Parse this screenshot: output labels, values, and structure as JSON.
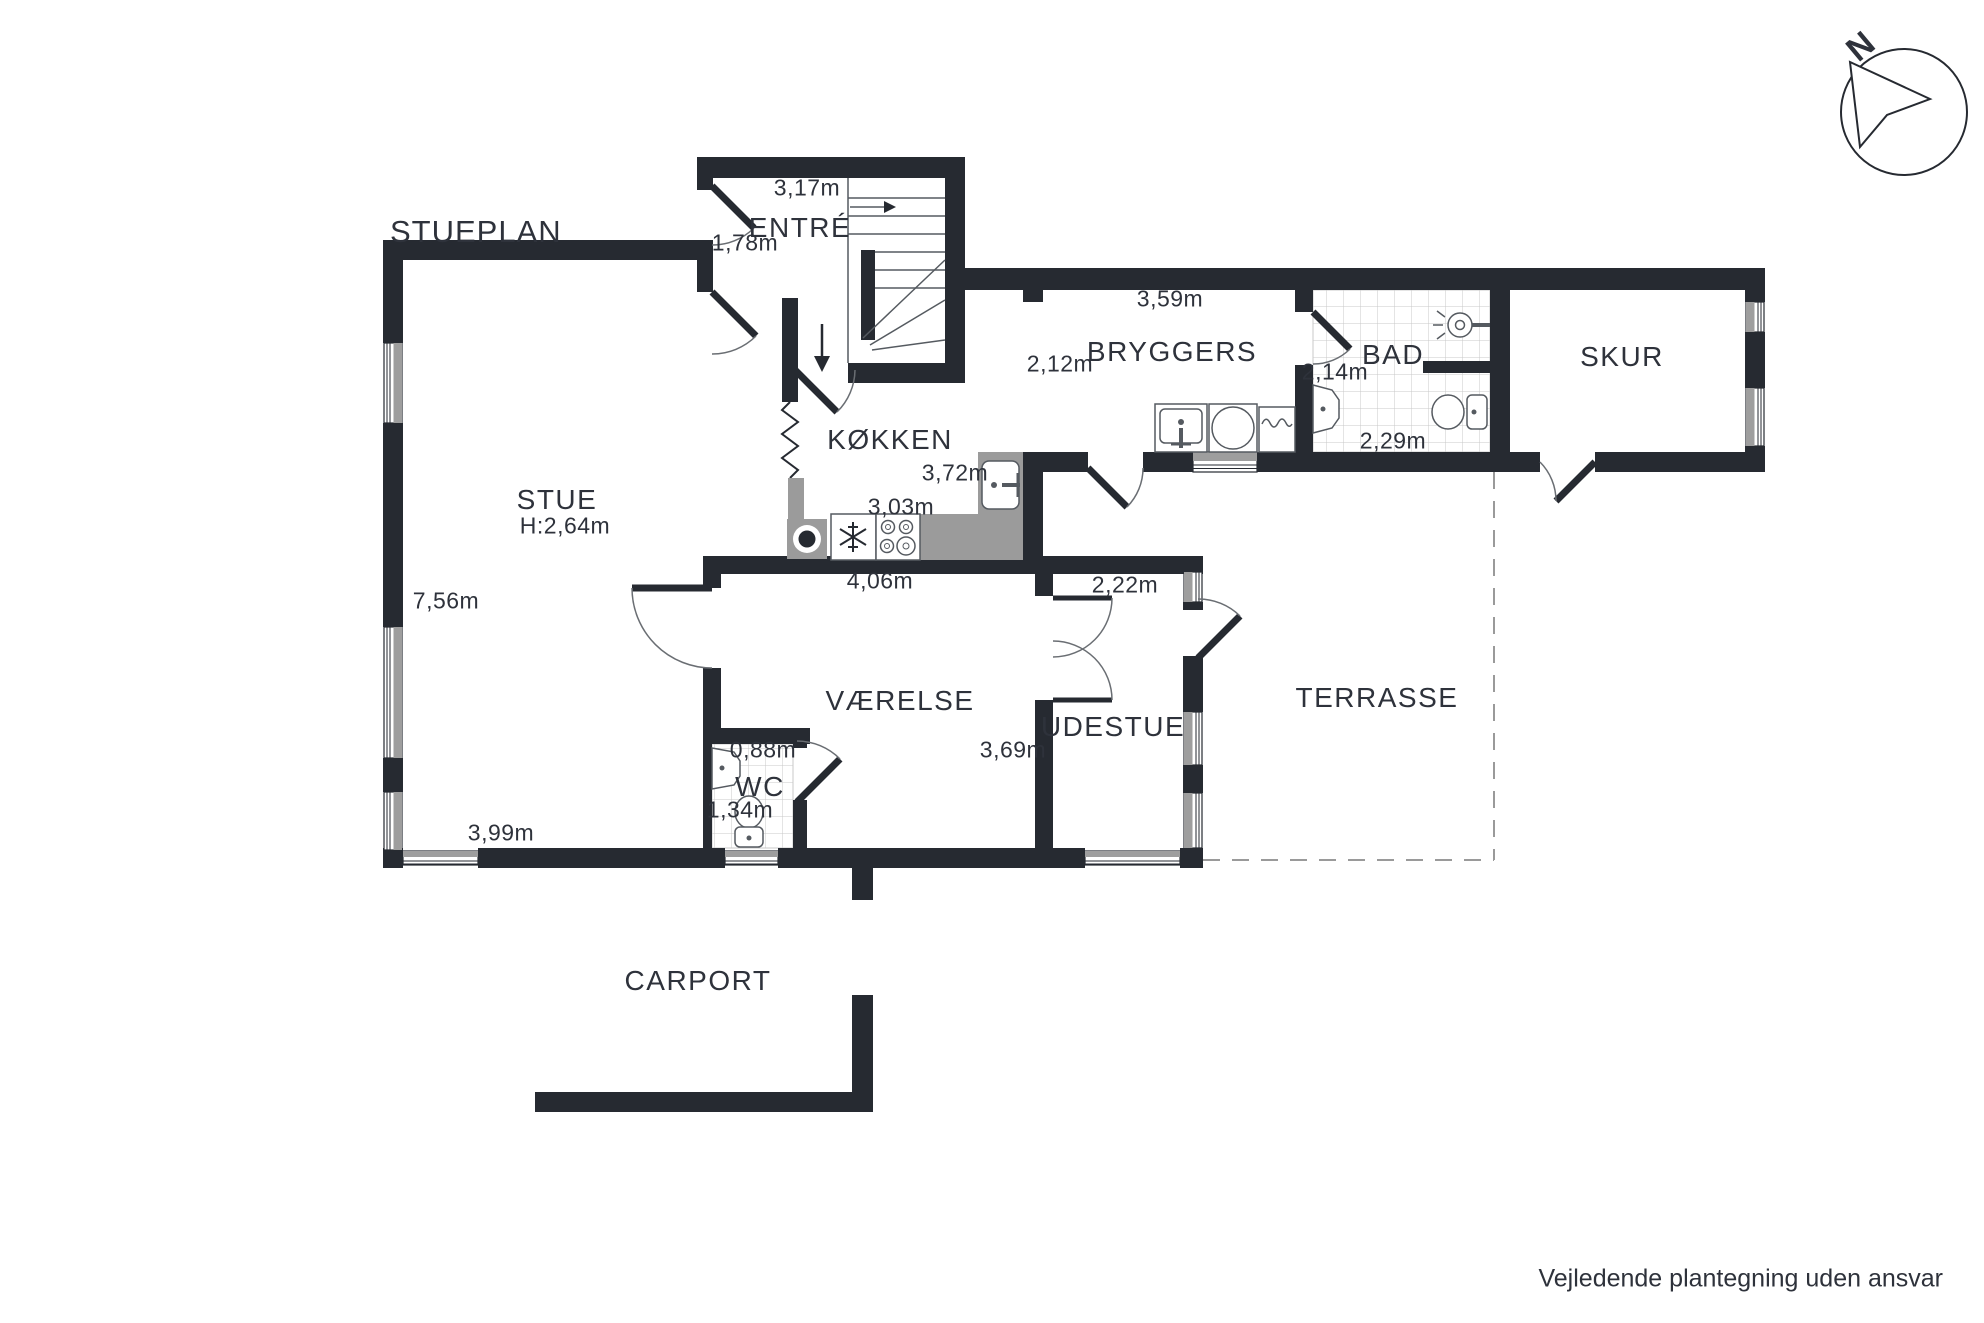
{
  "title": "STUEPLAN",
  "disclaimer": "Vejledende plantegning uden ansvar",
  "compass": {
    "north_label": "N"
  },
  "colors": {
    "wall": "#262a31",
    "counter": "#9b9b9b",
    "window_fill": "#9e9e9e",
    "tile_line": "#c9c9c9",
    "dash_line": "#9a9a9a",
    "text": "#2e323b"
  },
  "rooms": {
    "stue": {
      "name": "STUE",
      "ceiling_height": "H:2,64m",
      "dim_west": "7,56m",
      "dim_south": "3,99m"
    },
    "entre": {
      "name": "ENTRÉ",
      "dim_width": "3,17m",
      "dim_door": "1,78m"
    },
    "kokken": {
      "name": "KØKKEN",
      "dim_east": "3,72m",
      "dim_mid": "3,03m",
      "dim_south": "4,06m"
    },
    "bryggers": {
      "name": "BRYGGERS",
      "dim_north": "3,59m",
      "dim_opening": "2,12m"
    },
    "bad": {
      "name": "BAD",
      "dim_west": "2,14m",
      "dim_south": "2,29m"
    },
    "skur": {
      "name": "SKUR"
    },
    "vaerelse": {
      "name": "VÆRELSE",
      "dim_east": "3,69m"
    },
    "wc": {
      "name": "WC",
      "dim_north": "0,88m",
      "dim_west": "1,34m"
    },
    "udestue": {
      "name": "UDESTUE",
      "dim_north": "2,22m"
    },
    "terrasse": {
      "name": "TERRASSE"
    },
    "carport": {
      "name": "CARPORT"
    }
  }
}
